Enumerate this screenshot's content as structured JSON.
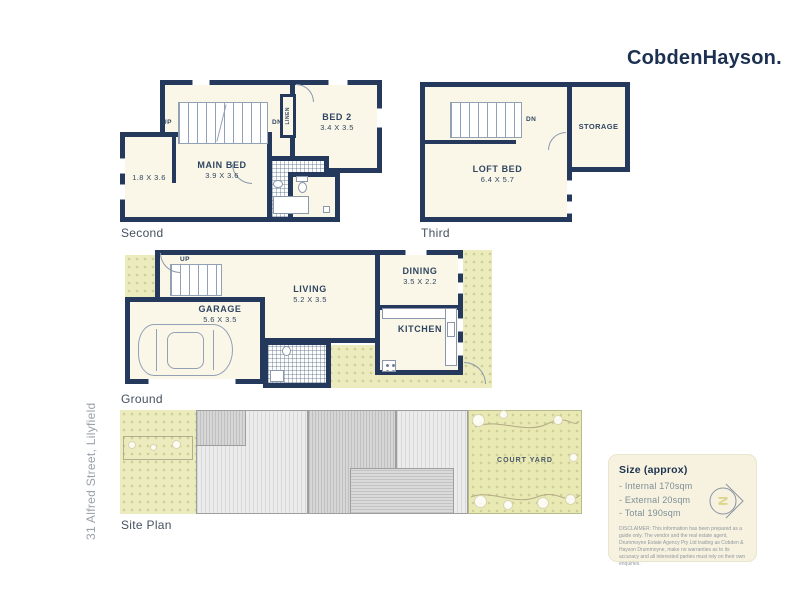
{
  "logo": "CobdenHayson.",
  "address_label": "31 Alfred Street, Lilyfield",
  "colors": {
    "wall": "#24395c",
    "floor": "#faf7e9",
    "garden": "#ebebbe",
    "logo_navy": "#1c3151",
    "compass_letter": "#d9d383"
  },
  "second": {
    "label": "Second",
    "up": "UP",
    "dn": "DN",
    "linen": "LINEN",
    "bed2_name": "BED 2",
    "bed2_dims": "3.4 X 3.5",
    "main_name": "MAIN BED",
    "main_dims": "3.9 X 3.6",
    "nook_dims": "1.8 X 3.6"
  },
  "third": {
    "label": "Third",
    "dn": "DN",
    "loft_name": "LOFT BED",
    "loft_dims": "6.4 X 5.7",
    "storage_name": "STORAGE"
  },
  "ground": {
    "label": "Ground",
    "up": "UP",
    "garage_name": "GARAGE",
    "garage_dims": "5.6 X 3.5",
    "living_name": "LIVING",
    "living_dims": "5.2 X 3.5",
    "dining_name": "DINING",
    "dining_dims": "3.5 X 2.2",
    "kitchen_name": "KITCHEN"
  },
  "site": {
    "label": "Site Plan",
    "courtyard_label": "COURT YARD"
  },
  "size_box": {
    "title": "Size (approx)",
    "items": [
      "- Internal 170sqm",
      "- External 20sqm",
      "- Total 190sqm"
    ],
    "compass_letter": "N",
    "disclaimer": "DISCLAIMER: This information has been prepared as a guide only. The vendor and the real estate agent, Drummoyne Estate Agency Pty Ltd trading as Cobden & Hayson Drummoyne, make no warranties as to its accuracy and all interested parties must rely on their own enquiries."
  }
}
